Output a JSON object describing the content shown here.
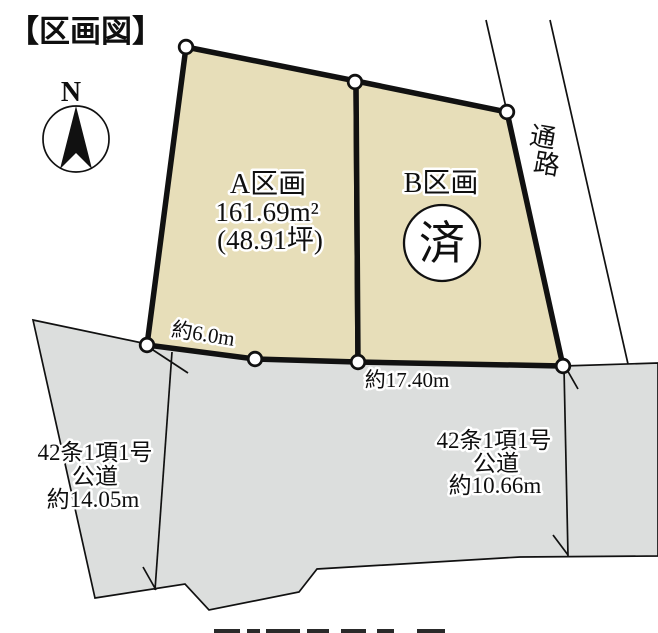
{
  "title": "【区画図】",
  "compass": {
    "north": "N"
  },
  "parcels": {
    "a": {
      "name": "A区画",
      "area_sqm": "161.69m²",
      "area_tsubo": "(48.91坪)"
    },
    "b": {
      "name": "B区画",
      "status_stamp": "済"
    }
  },
  "roads": {
    "passage": {
      "label": "通路",
      "chars": [
        "通",
        "路"
      ]
    },
    "left": {
      "line1": "42条1項1号",
      "line2": "公道",
      "line3": "約14.05m"
    },
    "bottom": {
      "line1": "42条1項1号",
      "line2": "公道",
      "line3": "約10.66m"
    }
  },
  "measurements": {
    "front_a": "約6.0m",
    "south_total": "約17.40m"
  },
  "colors": {
    "parcel_fill": "#e7deb9",
    "road_gray": "#dcdedd",
    "outline": "#111111",
    "text": "#0f0f0f"
  }
}
